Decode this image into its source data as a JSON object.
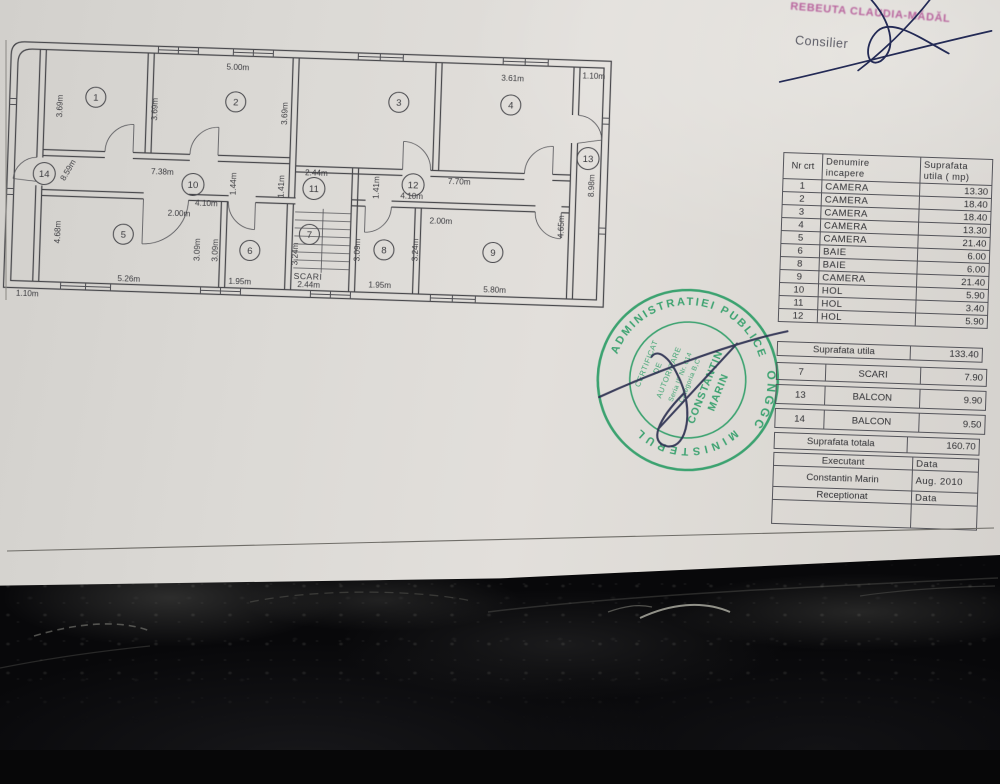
{
  "colors": {
    "paper": "#dcd9d5",
    "leather": "#0a0a0c",
    "stamp_green": "#2f9e68",
    "pen_blue": "#232a55",
    "signature_pink": "#b8639d",
    "print_gray": "#3c3c40"
  },
  "signature_area": {
    "name": "REBEUTA CLAUDIA-MĂDĂL",
    "role": "Consilier"
  },
  "floor_plan": {
    "stairs_label": "SCARI",
    "rooms": [
      {
        "n": "1",
        "x": 89,
        "y": 56
      },
      {
        "n": "2",
        "x": 229,
        "y": 56
      },
      {
        "n": "3",
        "x": 392,
        "y": 51
      },
      {
        "n": "4",
        "x": 504,
        "y": 50
      },
      {
        "n": "5",
        "x": 121,
        "y": 192
      },
      {
        "n": "6",
        "x": 248,
        "y": 204
      },
      {
        "n": "7",
        "x": 307,
        "y": 186
      },
      {
        "n": "8",
        "x": 382,
        "y": 199
      },
      {
        "n": "9",
        "x": 491,
        "y": 198
      },
      {
        "n": "10",
        "x": 189,
        "y": 140
      },
      {
        "n": "11",
        "x": 310,
        "y": 140
      },
      {
        "n": "12",
        "x": 409,
        "y": 133
      },
      {
        "n": "13",
        "x": 583,
        "y": 101
      },
      {
        "n": "14",
        "x": 40,
        "y": 134
      }
    ],
    "dimensions": [
      {
        "t": "5.00m",
        "x": 230,
        "y": 24
      },
      {
        "t": "3.61m",
        "x": 505,
        "y": 26
      },
      {
        "t": "1.10m",
        "x": 586,
        "y": 21
      },
      {
        "t": "3.69m",
        "x": 56,
        "y": 66,
        "r": -90
      },
      {
        "t": "3.69m",
        "x": 151,
        "y": 66,
        "r": -90
      },
      {
        "t": "3.69m",
        "x": 281,
        "y": 66,
        "r": -90
      },
      {
        "t": "8.59m",
        "x": 66,
        "y": 131,
        "r": -62
      },
      {
        "t": "7.38m",
        "x": 158,
        "y": 131
      },
      {
        "t": "1.44m",
        "x": 232,
        "y": 138,
        "r": -90
      },
      {
        "t": "2.44m",
        "x": 312,
        "y": 127
      },
      {
        "t": "1.41m",
        "x": 280,
        "y": 139,
        "r": -90
      },
      {
        "t": "1.41m",
        "x": 375,
        "y": 137,
        "r": -90
      },
      {
        "t": "7.70m",
        "x": 455,
        "y": 131
      },
      {
        "t": "4.10m",
        "x": 203,
        "y": 161
      },
      {
        "t": "4.10m",
        "x": 408,
        "y": 147
      },
      {
        "t": "2.00m",
        "x": 176,
        "y": 172
      },
      {
        "t": "2.00m",
        "x": 438,
        "y": 171
      },
      {
        "t": "4.68m",
        "x": 58,
        "y": 192,
        "r": -90
      },
      {
        "t": "3.09m",
        "x": 198,
        "y": 205,
        "r": -90
      },
      {
        "t": "3.09m",
        "x": 216,
        "y": 205,
        "r": -90
      },
      {
        "t": "3.24m",
        "x": 296,
        "y": 206,
        "r": -90
      },
      {
        "t": "3.09m",
        "x": 358,
        "y": 200,
        "r": -90
      },
      {
        "t": "3.24m",
        "x": 416,
        "y": 198,
        "r": -90
      },
      {
        "t": "4.65m",
        "x": 561,
        "y": 170,
        "r": -90
      },
      {
        "t": "8.98m",
        "x": 590,
        "y": 128,
        "r": -90
      },
      {
        "t": "5.26m",
        "x": 128,
        "y": 239
      },
      {
        "t": "1.95m",
        "x": 239,
        "y": 238
      },
      {
        "t": "2.44m",
        "x": 308,
        "y": 239
      },
      {
        "t": "1.95m",
        "x": 379,
        "y": 237
      },
      {
        "t": "5.80m",
        "x": 494,
        "y": 238
      },
      {
        "t": "1.10m",
        "x": 27,
        "y": 257
      }
    ]
  },
  "area_table": {
    "header": {
      "col1": "Nr crt",
      "col2": [
        "Denumire",
        "incapere"
      ],
      "col3": [
        "Suprafata",
        "utila ( mp)"
      ]
    },
    "rows": [
      [
        "1",
        "CAMERA",
        "13.30"
      ],
      [
        "2",
        "CAMERA",
        "18.40"
      ],
      [
        "3",
        "CAMERA",
        "18.40"
      ],
      [
        "4",
        "CAMERA",
        "13.30"
      ],
      [
        "5",
        "CAMERA",
        "21.40"
      ],
      [
        "6",
        "BAIE",
        "6.00"
      ],
      [
        "8",
        "BAIE",
        "6.00"
      ],
      [
        "9",
        "CAMERA",
        "21.40"
      ],
      [
        "10",
        "HOL",
        "5.90"
      ],
      [
        "11",
        "HOL",
        "3.40"
      ],
      [
        "12",
        "HOL",
        "5.90"
      ]
    ],
    "summary_utila": {
      "label": "Suprafata utila",
      "value": "133.40"
    },
    "extra_rows": [
      [
        "7",
        "SCARI",
        "7.90"
      ],
      [
        "13",
        "BALCON",
        "9.90"
      ],
      [
        "14",
        "BALCON",
        "9.50"
      ]
    ],
    "summary_totala": {
      "label": "Suprafata totala",
      "value": "160.70"
    },
    "footer": [
      [
        "Executant",
        "Data"
      ],
      [
        "Constantin Marin",
        "Aug. 2010"
      ],
      [
        "Receptionat",
        "Data"
      ],
      [
        "",
        ""
      ]
    ]
  },
  "stamp": {
    "ring_top": "ADMINISTRATIEI PUBLICE",
    "ring_bottom": "MINISTERUL",
    "ring_right": "ONGGC",
    "inner_lines": [
      "CERTIFICAT",
      "DE",
      "AUTORIZARE",
      "Seria IF Nr. 014",
      "Categoria B,C"
    ],
    "name_lines": [
      "CONSTANTIN",
      "MARIN"
    ]
  }
}
